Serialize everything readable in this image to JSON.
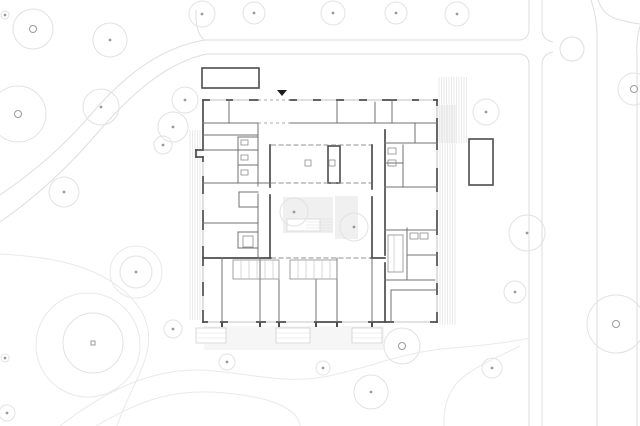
{
  "canvas": {
    "w": 640,
    "h": 426,
    "bg": "#ffffff"
  },
  "palette": {
    "contour": "#e9e9e9",
    "road": "#dedede",
    "tree_stroke": "#e2e2e2",
    "tree_marker": "#9a9a9a",
    "wall_dark": "#4d4d4d",
    "wall_med": "#707070",
    "wall_xlight": "#bdbdbd",
    "wall_light_rect": "#8c8c8c",
    "glaze": "#909090",
    "canopy_dash": "#a8a8a8",
    "hatch": "#dcdcdc",
    "court_fill": "#f0f0f0",
    "court_inner_stroke": "#dcdcdc",
    "window": "#b3b3b3",
    "step_stroke": "#cfcfcf",
    "step_tread": "#e0e0e0",
    "triangle": "#1c1c1c"
  },
  "plan": {
    "roads": {
      "paths": [
        "M518,40 L205,40 C162,47 126,74 93,112 C61,150 28,176 0,195",
        "M518,54 L207,54 C168,62 133,92 100,130 C66,170 32,200 0,222",
        "M196,10 Q195,32 204,40",
        "M518,40 Q529,40 529,29 L529,0",
        "M518,54 Q529,54 529,65 L529,426",
        "M542,0 L542,29 Q542,40 553,42",
        "M553,52 Q542,54 542,65 L542,426",
        "M591,0 Q597,18 597,36 L597,426",
        "M640,26 Q636,40 637,54 L637,426",
        "M598,0 Q603,15 617,19 Q631,23 640,24"
      ],
      "circle": {
        "cx": 572,
        "cy": 49,
        "r": 12
      }
    },
    "contours": {
      "paths": [
        "M0,254 C55,257 95,266 124,291 C146,310 152,330 147,352 C141,377 126,398 117,426",
        "M60,426 C110,387 160,365 215,371 C262,376 287,383 323,377 C367,369 400,352 452,348 C488,345 512,342 529,338",
        "M96,426 C140,400 175,388 225,393 C270,397 298,408 300,426",
        "M444,426 C443,408 448,390 462,378 C478,365 502,355 520,346"
      ],
      "circles": [
        {
          "cx": 88,
          "cy": 345,
          "r": 52
        },
        {
          "cx": 136,
          "cy": 272,
          "r": 26
        }
      ]
    },
    "trees": [
      {
        "x": 33,
        "y": 29,
        "r": 20,
        "m": "ring"
      },
      {
        "x": 110,
        "y": 40,
        "r": 17,
        "m": "dot"
      },
      {
        "x": 202,
        "y": 14,
        "r": 13,
        "m": "dot"
      },
      {
        "x": 254,
        "y": 13,
        "r": 11,
        "m": "dot"
      },
      {
        "x": 333,
        "y": 13,
        "r": 12,
        "m": "dot"
      },
      {
        "x": 396,
        "y": 13,
        "r": 11,
        "m": "dot"
      },
      {
        "x": 457,
        "y": 14,
        "r": 12,
        "m": "dot"
      },
      {
        "x": 5,
        "y": 15,
        "r": 4,
        "m": "dot"
      },
      {
        "x": 18,
        "y": 114,
        "r": 28,
        "m": "ring"
      },
      {
        "x": 101,
        "y": 107,
        "r": 18,
        "m": "dot"
      },
      {
        "x": 185,
        "y": 100,
        "r": 13,
        "m": "dot"
      },
      {
        "x": 173,
        "y": 127,
        "r": 15,
        "m": "dot"
      },
      {
        "x": 163,
        "y": 145,
        "r": 9,
        "m": "dot"
      },
      {
        "x": 64,
        "y": 192,
        "r": 15,
        "m": "dot"
      },
      {
        "x": 136,
        "y": 272,
        "r": 16,
        "m": "dot"
      },
      {
        "x": 93,
        "y": 343,
        "r": 30,
        "m": "square"
      },
      {
        "x": 173,
        "y": 329,
        "r": 9,
        "m": "dot"
      },
      {
        "x": 5,
        "y": 358,
        "r": 4,
        "m": "dot"
      },
      {
        "x": 7,
        "y": 413,
        "r": 8,
        "m": "dot"
      },
      {
        "x": 227,
        "y": 362,
        "r": 8,
        "m": "dot"
      },
      {
        "x": 323,
        "y": 368,
        "r": 7,
        "m": "dot"
      },
      {
        "x": 371,
        "y": 392,
        "r": 17,
        "m": "dot"
      },
      {
        "x": 402,
        "y": 346,
        "r": 18,
        "m": "ring"
      },
      {
        "x": 492,
        "y": 368,
        "r": 10,
        "m": "dot"
      },
      {
        "x": 527,
        "y": 233,
        "r": 18,
        "m": "dot"
      },
      {
        "x": 515,
        "y": 292,
        "r": 11,
        "m": "dot"
      },
      {
        "x": 616,
        "y": 324,
        "r": 29,
        "m": "ring"
      },
      {
        "x": 634,
        "y": 89,
        "r": 16,
        "m": "ring"
      },
      {
        "x": 486,
        "y": 112,
        "r": 13,
        "m": "dot"
      },
      {
        "x": 294,
        "y": 212,
        "r": 14,
        "m": "dot"
      },
      {
        "x": 354,
        "y": 227,
        "r": 14,
        "m": "dot"
      }
    ],
    "courtyard": {
      "areas": [
        {
          "x": 283,
          "y": 197,
          "w": 50,
          "h": 36
        },
        {
          "x": 335,
          "y": 196,
          "w": 23,
          "h": 43
        }
      ],
      "inner_rect": {
        "x": 287,
        "y": 219,
        "w": 33,
        "h": 12
      }
    },
    "hatches": [
      {
        "x": 204,
        "y": 327,
        "w": 180,
        "h": 22,
        "dir": "h",
        "step": 2
      },
      {
        "x": 439,
        "y": 77,
        "w": 28,
        "h": 66,
        "dir": "v",
        "step": 2.5
      },
      {
        "x": 440,
        "y": 105,
        "w": 15,
        "h": 220,
        "dir": "v",
        "step": 2.5
      },
      {
        "x": 190,
        "y": 130,
        "w": 12,
        "h": 190,
        "dir": "v",
        "step": 2.5
      },
      {
        "x": 306,
        "y": 219,
        "w": 27,
        "h": 13,
        "dir": "h",
        "step": 3
      }
    ],
    "steps": [
      {
        "x": 196,
        "y": 328,
        "w": 30,
        "h": 15
      },
      {
        "x": 276,
        "y": 328,
        "w": 34,
        "h": 15
      },
      {
        "x": 352,
        "y": 328,
        "w": 30,
        "h": 15
      }
    ],
    "building": {
      "walls_dark": [
        [
          203,
          100,
          258,
          100
        ],
        [
          290,
          100,
          437,
          100
        ],
        [
          437,
          100,
          437,
          322
        ],
        [
          203,
          322,
          437,
          322
        ],
        [
          203,
          100,
          203,
          150
        ],
        [
          196,
          150,
          203,
          150
        ],
        [
          196,
          150,
          196,
          157
        ],
        [
          196,
          157,
          203,
          157
        ],
        [
          203,
          157,
          203,
          322
        ],
        [
          270,
          145,
          270,
          187
        ],
        [
          270,
          195,
          270,
          258
        ],
        [
          372,
          145,
          372,
          189
        ],
        [
          372,
          197,
          372,
          258
        ],
        [
          203,
          258,
          271,
          258
        ],
        [
          371,
          258,
          385,
          258
        ],
        [
          385,
          130,
          385,
          255
        ],
        [
          385,
          263,
          385,
          322
        ]
      ],
      "walls_med": [
        [
          203,
          123,
          258,
          123
        ],
        [
          290,
          123,
          437,
          123
        ],
        [
          229,
          100,
          229,
          123
        ],
        [
          337,
          100,
          337,
          123
        ],
        [
          375,
          100,
          375,
          123
        ],
        [
          392,
          100,
          392,
          123
        ],
        [
          415,
          123,
          415,
          143
        ],
        [
          203,
          135,
          258,
          135
        ],
        [
          385,
          143,
          437,
          143
        ],
        [
          258,
          123,
          258,
          186
        ],
        [
          258,
          194,
          258,
          258
        ],
        [
          238,
          137,
          238,
          183
        ],
        [
          238,
          137,
          258,
          137
        ],
        [
          238,
          150,
          258,
          150
        ],
        [
          238,
          165,
          258,
          165
        ],
        [
          203,
          150,
          238,
          150
        ],
        [
          238,
          183,
          258,
          183
        ],
        [
          203,
          183,
          270,
          183
        ],
        [
          239,
          192,
          258,
          192
        ],
        [
          239,
          192,
          239,
          207
        ],
        [
          239,
          207,
          258,
          207
        ],
        [
          203,
          223,
          258,
          223
        ],
        [
          238,
          232,
          258,
          232
        ],
        [
          238,
          232,
          238,
          248
        ],
        [
          238,
          248,
          258,
          248
        ],
        [
          403,
          145,
          403,
          187
        ],
        [
          385,
          163,
          403,
          163
        ],
        [
          385,
          187,
          437,
          187
        ],
        [
          385,
          230,
          437,
          230
        ],
        [
          407,
          228,
          407,
          280
        ],
        [
          407,
          255,
          437,
          255
        ],
        [
          385,
          280,
          437,
          280
        ],
        [
          391,
          290,
          437,
          290
        ],
        [
          391,
          290,
          391,
          322
        ],
        [
          222,
          258,
          222,
          322
        ],
        [
          260,
          258,
          260,
          322
        ],
        [
          337,
          258,
          337,
          322
        ],
        [
          372,
          258,
          372,
          322
        ],
        [
          279,
          280,
          279,
          322
        ],
        [
          316,
          280,
          316,
          322
        ]
      ],
      "walls_xlight": [
        [
          241,
          261,
          241,
          278
        ],
        [
          249,
          261,
          249,
          278
        ],
        [
          257,
          261,
          257,
          278
        ],
        [
          265,
          261,
          265,
          278
        ],
        [
          273,
          261,
          273,
          278
        ],
        [
          298,
          261,
          298,
          278
        ],
        [
          306,
          261,
          306,
          278
        ],
        [
          314,
          261,
          314,
          278
        ],
        [
          322,
          261,
          322,
          278
        ],
        [
          330,
          261,
          330,
          278
        ],
        [
          394,
          235,
          394,
          272
        ]
      ],
      "rects_dark": [
        {
          "x": 202,
          "y": 68,
          "w": 57,
          "h": 20
        },
        {
          "x": 469,
          "y": 139,
          "w": 24,
          "h": 46
        },
        {
          "x": 328,
          "y": 146,
          "w": 12,
          "h": 37
        }
      ],
      "rects_light": [
        {
          "x": 233,
          "y": 260,
          "w": 46,
          "h": 19
        },
        {
          "x": 290,
          "y": 260,
          "w": 47,
          "h": 19
        },
        {
          "x": 388,
          "y": 235,
          "w": 15,
          "h": 37
        },
        {
          "x": 241,
          "y": 140,
          "w": 7,
          "h": 5
        },
        {
          "x": 241,
          "y": 155,
          "w": 7,
          "h": 5
        },
        {
          "x": 241,
          "y": 170,
          "w": 7,
          "h": 5
        },
        {
          "x": 243,
          "y": 236,
          "w": 10,
          "h": 11
        },
        {
          "x": 388,
          "y": 148,
          "w": 8,
          "h": 6
        },
        {
          "x": 388,
          "y": 160,
          "w": 8,
          "h": 6
        },
        {
          "x": 410,
          "y": 233,
          "w": 8,
          "h": 6
        },
        {
          "x": 420,
          "y": 233,
          "w": 8,
          "h": 6
        },
        {
          "x": 305,
          "y": 160,
          "w": 6,
          "h": 6
        },
        {
          "x": 329,
          "y": 160,
          "w": 6,
          "h": 6
        }
      ],
      "glaze": [
        [
          271,
          145,
          371,
          145
        ],
        [
          271,
          183,
          371,
          183
        ],
        [
          271,
          258,
          371,
          258
        ]
      ],
      "canopy": [
        [
          258,
          100,
          290,
          100
        ],
        [
          258,
          123,
          290,
          123
        ]
      ],
      "windows": [
        {
          "o": "h",
          "c": 100,
          "spans": [
            [
              210,
              226
            ],
            [
              233,
              249
            ],
            [
              297,
              313
            ],
            [
              321,
              336
            ],
            [
              344,
              359
            ],
            [
              367,
              382
            ],
            [
              397,
              412
            ],
            [
              419,
              433
            ]
          ]
        },
        {
          "o": "v",
          "c": 437,
          "spans": [
            [
              106,
              118
            ],
            [
              150,
              168
            ],
            [
              192,
              210
            ],
            [
              235,
              252
            ],
            [
              266,
              283
            ],
            [
              295,
              312
            ]
          ]
        },
        {
          "o": "v",
          "c": 203,
          "spans": [
            [
              162,
              176
            ],
            [
              194,
              210
            ],
            [
              230,
              246
            ],
            [
              266,
              282
            ],
            [
              296,
              310
            ]
          ]
        },
        {
          "o": "h",
          "c": 322,
          "spans": [
            [
              208,
              220
            ],
            [
              228,
              256
            ],
            [
              266,
              276
            ],
            [
              286,
              314
            ],
            [
              342,
              368
            ],
            [
              394,
              430
            ]
          ]
        }
      ],
      "piers": [
        222,
        260,
        279,
        316,
        337,
        372
      ],
      "entrance_triangle": "277,90 287,90 282,96"
    }
  }
}
